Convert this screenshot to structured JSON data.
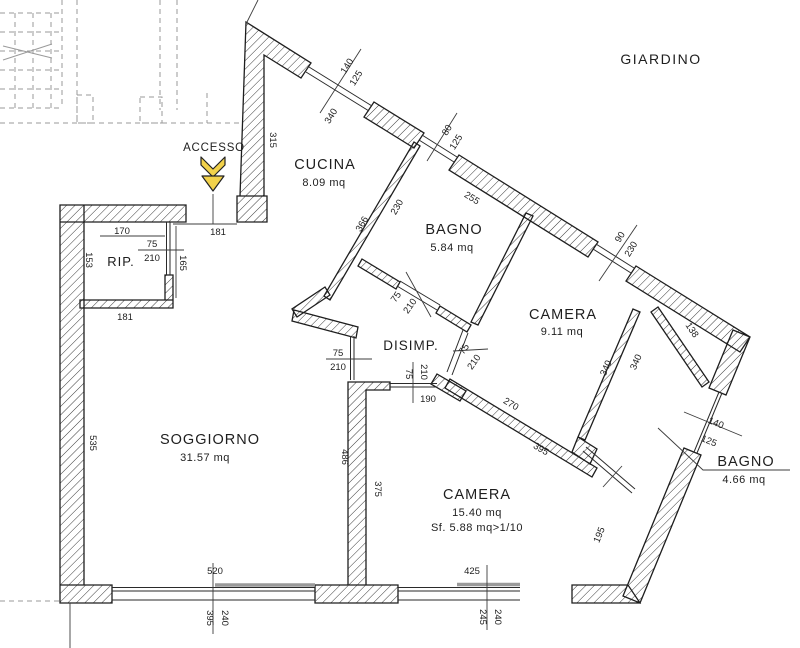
{
  "outside": {
    "giardino": "GIARDINO",
    "accesso": "ACCESSO"
  },
  "rooms": {
    "cucina": {
      "name": "CUCINA",
      "area": "8.09 mq"
    },
    "bagno1": {
      "name": "BAGNO",
      "area": "5.84 mq"
    },
    "camera1": {
      "name": "CAMERA",
      "area": "9.11 mq"
    },
    "disimpegno": {
      "name": "DISIMP."
    },
    "rip": {
      "name": "RIP."
    },
    "soggiorno": {
      "name": "SOGGIORNO",
      "area": "31.57 mq"
    },
    "camera2": {
      "name": "CAMERA",
      "area": "15.40 mq",
      "note": "Sf. 5.88 mq>1/10"
    },
    "bagno2": {
      "name": "BAGNO",
      "area": "4.66 mq"
    }
  },
  "dims": {
    "cucina_window_w": "140",
    "cucina_window_h": "125",
    "cucina_window_sill": "340",
    "small_window_w": "80",
    "small_window_h": "125",
    "ne_wall_seg": "255",
    "ne_door_w": "90",
    "ne_door_h": "230",
    "west_upper_wall": "315",
    "cucina_wall_a": "366",
    "cucina_wall_b": "230",
    "rip_width": "170",
    "rip_door_w": "75",
    "rip_door_h": "210",
    "rip_left": "153",
    "rip_right": "165",
    "rip_bottom": "181",
    "entry_width": "181",
    "sogg_door_w": "75",
    "sogg_door_h": "210",
    "camera2_door_w": "75",
    "camera2_door_h": "210",
    "camera2_door_off": "190",
    "bagno1_door_w": "75",
    "bagno1_door_h": "210",
    "camera1_door_w": "75",
    "camera1_door_h": "210",
    "camera1_wall_a": "270",
    "camera1_wall_b": "395",
    "bagno2_wall_l": "340",
    "bagno2_wall_r": "340",
    "bagno2_niche": "138",
    "bagno2_window_w": "140",
    "bagno2_window_h": "125",
    "se_wall_seg": "195",
    "west_wall": "535",
    "divider_left": "486",
    "divider_right": "375",
    "sogg_window": "520",
    "camera2_window": "425",
    "sogg_win_a": "395",
    "sogg_win_b": "240",
    "cam_win_a": "245",
    "cam_win_b": "240"
  },
  "colors": {
    "line": "#1e1e1e",
    "hatch": "#3a3a3a",
    "dash_gray": "#9a9a9a",
    "sill_gray": "#9a9a9a",
    "arrow_yellow": "#f2d24b"
  }
}
